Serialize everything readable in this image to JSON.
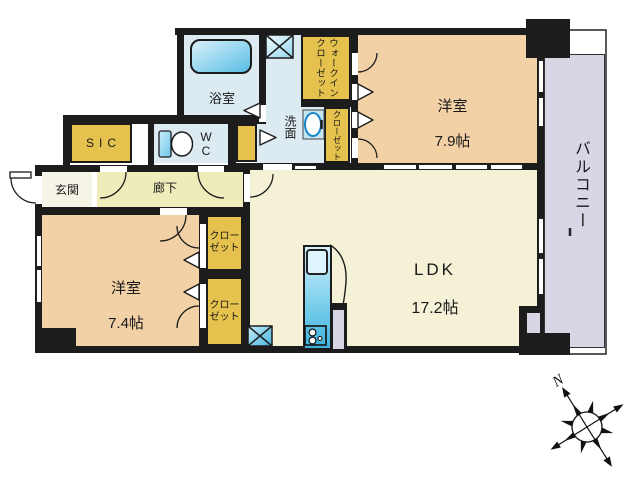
{
  "rooms": {
    "bathroom": {
      "label": "浴室"
    },
    "washroom": {
      "label": "洗面"
    },
    "wc": {
      "label": "WC"
    },
    "sic": {
      "label": "SIC"
    },
    "entrance": {
      "label": "玄関"
    },
    "corridor": {
      "label": "廊下"
    },
    "bedroom1": {
      "name": "洋室",
      "size": "7.9帖"
    },
    "bedroom2": {
      "name": "洋室",
      "size": "7.4帖"
    },
    "ldk": {
      "name": "LDK",
      "size": "17.2帖"
    },
    "walk_in_closet": {
      "label": "ウォークイン\nクローゼット"
    },
    "closet_hall": {
      "label": "クローゼット"
    },
    "closet_bed2_top": {
      "label": "クロー\nゼット"
    },
    "closet_bed2_bottom": {
      "label": "クロー\nゼット"
    },
    "balcony": {
      "label": "バルコニー"
    }
  },
  "compass": {
    "north_label": "N"
  },
  "colors": {
    "wall": "#1c1c1c",
    "bedroom": "#f3d1a7",
    "ldk": "#f4f1d6",
    "corridor": "#efecbc",
    "entrance": "#f6f4e6",
    "wet": "#dcebf2",
    "closet": "#e5c14d",
    "balcony": "#d6d6e5",
    "water": "#58bee6"
  }
}
